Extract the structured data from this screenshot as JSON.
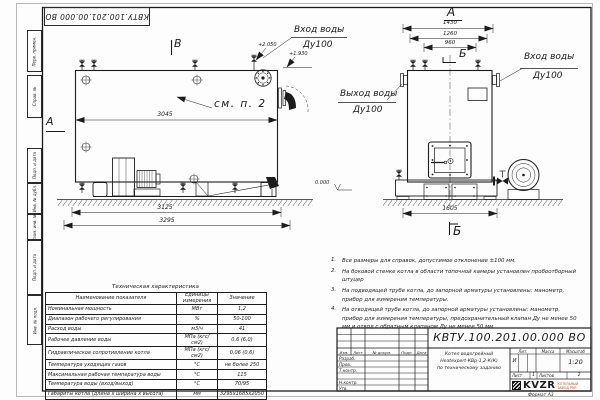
{
  "doc": {
    "number": "КВТУ.100.201.00.000  ВО",
    "stamp_number": "КВТУ.100.201.00.000 ВО",
    "title_line1": "Котел водогрейный",
    "title_line2": "Heatexpert-КВр-1,2-К(К)",
    "title_line3": "по техническому заданию",
    "liter_header": "Лит.",
    "mass_header": "Масса",
    "scale_header": "Масштаб",
    "liter_value": "И",
    "scale_value": "1:20",
    "sheet_label": "Лист",
    "sheet_value": "1",
    "sheets_label": "Листов",
    "sheets_value": "2",
    "format_label": "Формат   А3",
    "logo_text": "KVZR",
    "logo_sub1": "КОТЕЛЬНЫЙ",
    "logo_sub2": "ЗАВОД РЭП",
    "header_cols": {
      "izm": "Изм.",
      "list": "Лист",
      "doc": "№ докум.",
      "podp": "Подп.",
      "data": "Дата"
    },
    "roles": {
      "r1": "Разраб.",
      "r2": "Пров.",
      "r3": "Т.контр.",
      "r4": "",
      "r5": "Н.контр.",
      "r6": "Утв."
    }
  },
  "frame": {
    "c1": "Перв. примен.",
    "c2": "Справ. №",
    "c3": "Подп. и дата",
    "c4": "Инв. № дубл.",
    "c5": "Взам. инв. №",
    "c6": "Подп. и дата",
    "c7": "Инв. № подл."
  },
  "side": {
    "view_b": "В",
    "section_a": "А",
    "see_note": "см. п. 2",
    "dim_top": "3045",
    "dim_mid": "3125",
    "dim_bottom": "3295",
    "elev_1": "+2.050",
    "elev_2": "+1.930",
    "inlet_1": "Вход воды",
    "inlet_2": "Ду100"
  },
  "front": {
    "view_a": "А",
    "axis_b": "Б",
    "section_b": "Б",
    "dim_1": "1430",
    "dim_2": "1260",
    "dim_3": "960",
    "dim_base": "1605",
    "outlet_1": "Выход воды",
    "outlet_2": "Ду100",
    "inlet_1": "Вход воды",
    "inlet_2": "Ду100",
    "elev_zero": "0.000"
  },
  "notes": {
    "label_1": "1.",
    "text_1": "Все размеры для справок, допустимое отклонение ±100 мм.",
    "label_2": "2.",
    "text_2": "На боковой стенке котла в области топочной камеры установлен пробоотборный штуцер",
    "label_3": "3.",
    "text_3": "На  подводящей трубе котла, до запорной арматуры установлены: манометр, прибор для измерения температуры.",
    "label_4": "4.",
    "text_4": "На отводящей трубе котла, до запорной арматуры установлены: манометр, прибор для измерения температуры, предохранительный клапан Ду не менее 50 мм и отвод с обратным клапаном Ду не менее 50 мм."
  },
  "spec": {
    "title": "Техническая характеристика",
    "h_name": "Наименование показателя",
    "h_units": "Единицы измерения",
    "h_value": "Значение",
    "rows": [
      {
        "n": "Номинальная мощность",
        "u": "МВт",
        "v": "1,2"
      },
      {
        "n": "Диапазон рабочего регулирования",
        "u": "%",
        "v": "50-100"
      },
      {
        "n": "Расход воды",
        "u": "м3/ч",
        "v": "41"
      },
      {
        "n": "Рабочее давление воды",
        "u": "МПа (кгс/см2)",
        "v": "0,6 (6,0)"
      },
      {
        "n": "Гидравлическое сопротивление котла",
        "u": "МПа (кгс/см2)",
        "v": "0,06 (0,6)"
      },
      {
        "n": "Температура уходящих газов",
        "u": "°С",
        "v": "не более 250"
      },
      {
        "n": "Максимальная рабочая температура воды",
        "u": "°С",
        "v": "115"
      },
      {
        "n": "Температура воды (вход/выход)",
        "u": "°С",
        "v": "70/95"
      },
      {
        "n": "Габариты котла (длина х ширина х высота)",
        "u": "мм",
        "v": "3295х1685х2050"
      }
    ]
  }
}
